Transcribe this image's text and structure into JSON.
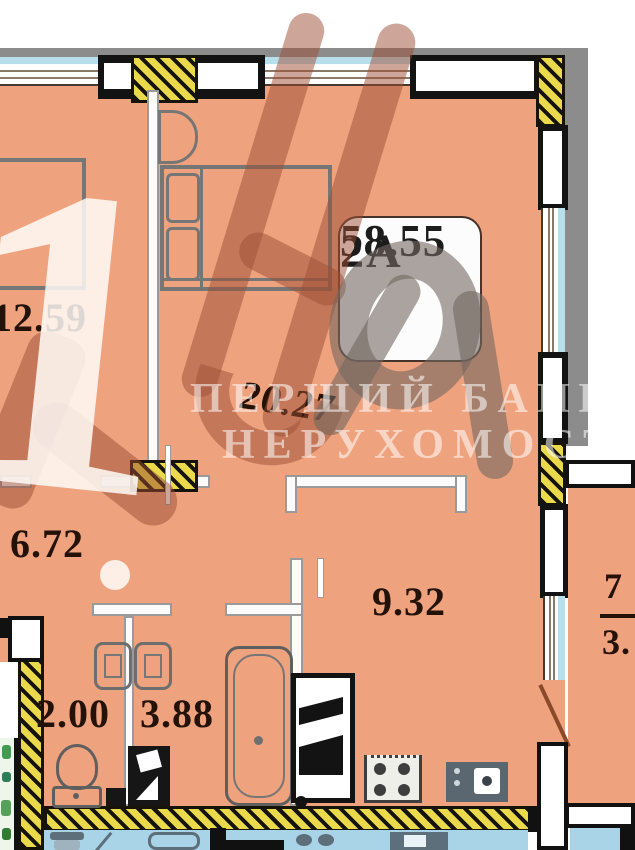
{
  "unit_badge": {
    "code": "2A",
    "total_area": "58.55"
  },
  "room_labels": {
    "bedroom_left": "12.59",
    "living_room": "20.27",
    "hall": "6.72",
    "wc": "2.00",
    "bathroom": "3.88",
    "kitchen": "9.32",
    "balcony_full": "7",
    "balcony_reduced": "3."
  },
  "watermark": {
    "big_digit": "1",
    "brand_line1": "ПЕРШИЙ БАНК",
    "brand_line2": "НЕРУХОМОСТІ"
  },
  "colors": {
    "floor_fill": "#efa27e",
    "structural_hatch_yellow": "#e9d94b",
    "glazing_blue": "#badfec",
    "exterior_band_gray": "#8c8c8c",
    "adjacent_unit_below_fill": "#a9d3e6",
    "adjacent_unit_left_accent": "#3f9b4f",
    "label_ink": "#241209"
  },
  "fixtures": [
    "wardrobe",
    "bed",
    "nightstand",
    "double-sink",
    "toilet",
    "washing-machine",
    "bathtub",
    "fridge",
    "stove",
    "kitchen-sink"
  ]
}
